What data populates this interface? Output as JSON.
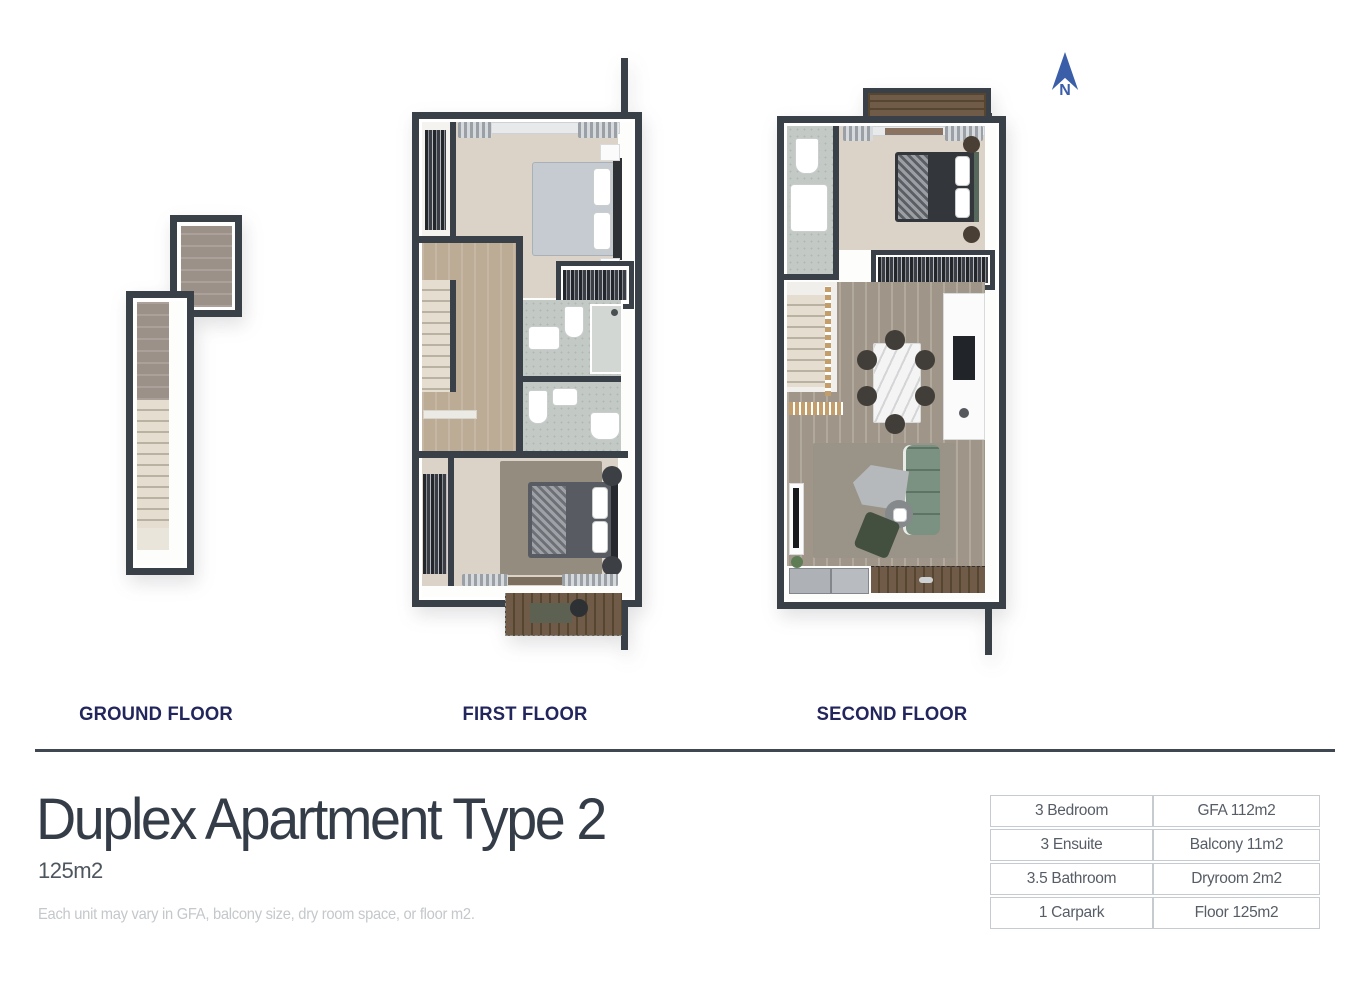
{
  "page": {
    "title": "Duplex Apartment Type 2",
    "subtitle": "125m2",
    "disclaimer": "Each unit may vary in GFA, balcony size, dry room space, or floor m2."
  },
  "compass": {
    "label": "N",
    "icon": "north-arrow-icon",
    "color": "#3b5ea9"
  },
  "floors": [
    {
      "label": "GROUND FLOOR"
    },
    {
      "label": "FIRST FLOOR"
    },
    {
      "label": "SECOND FLOOR"
    }
  ],
  "spec_table": {
    "rows": [
      [
        "3 Bedroom",
        "GFA 112m2"
      ],
      [
        "3 Ensuite",
        "Balcony 11m2"
      ],
      [
        "3.5 Bathroom",
        "Dryroom 2m2"
      ],
      [
        "1 Carpark",
        "Floor 125m2"
      ]
    ]
  },
  "colors": {
    "wall": "#394048",
    "floor_label_navy": "#23265c",
    "title_text": "#343d47",
    "divider": "#3f4753",
    "north_arrow_blue": "#3b5ea9"
  }
}
